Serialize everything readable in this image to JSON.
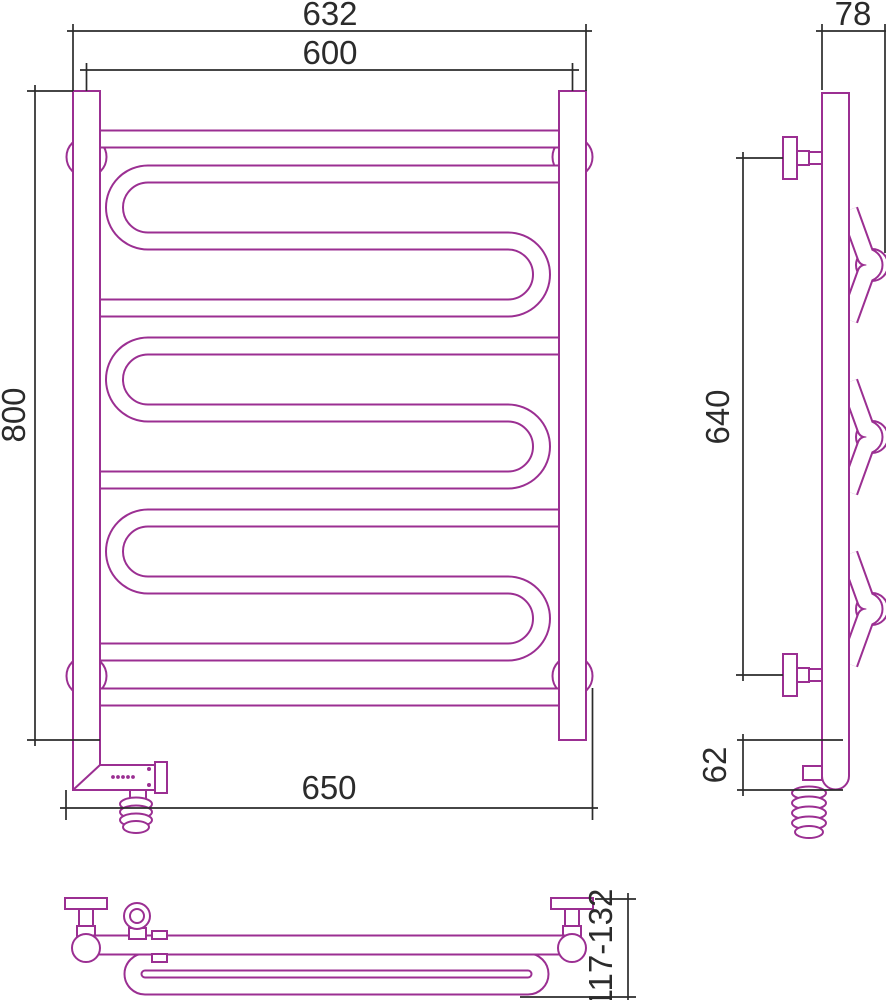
{
  "colors": {
    "product_outline": "#9B2F92",
    "dimension_lines": "#2B2B2B",
    "background": "#FFFFFF"
  },
  "front_view": {
    "dim_overall_width": "632",
    "dim_center_width": "600",
    "dim_height": "800",
    "dim_bottom_width": "650"
  },
  "side_view": {
    "dim_depth": "78",
    "dim_bracket_spacing": "640",
    "dim_bottom_drop": "62"
  },
  "bottom_view": {
    "dim_wall_distance": "117-132"
  }
}
